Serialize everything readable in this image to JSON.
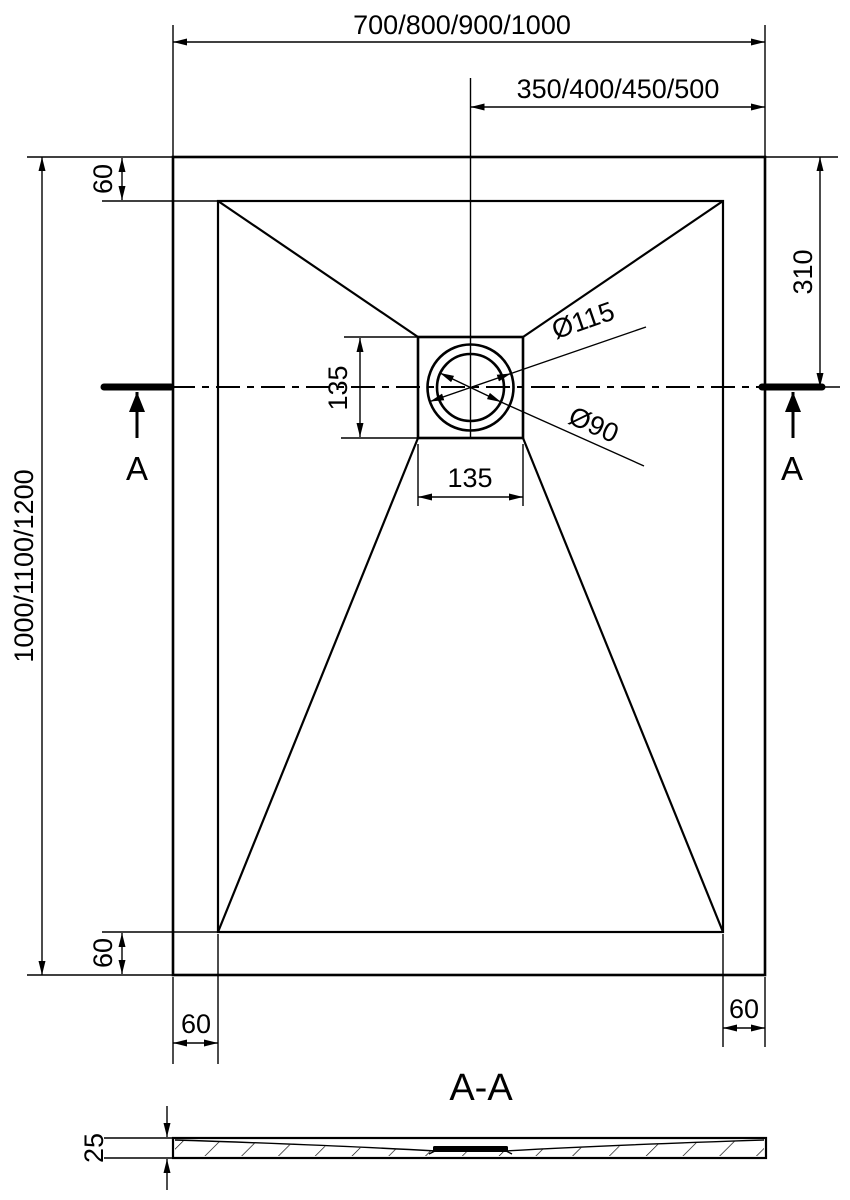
{
  "drawing": {
    "colors": {
      "line": "#000000",
      "background": "#ffffff"
    },
    "dims": {
      "overall_width": "700/800/900/1000",
      "center_to_edge": "350/400/450/500",
      "overall_length": "1000/1100/1200",
      "drain_from_top": "310",
      "rim_top": "60",
      "rim_bottom": "60",
      "rim_bottom_left": "60",
      "rim_bottom_right": "60",
      "drain_square_height": "135",
      "drain_square_width": "135",
      "drain_outer_dia": "Ø115",
      "drain_inner_dia": "Ø90"
    },
    "section": {
      "marker_left": "A",
      "marker_right": "A",
      "title": "A-A",
      "thickness": "25"
    }
  }
}
